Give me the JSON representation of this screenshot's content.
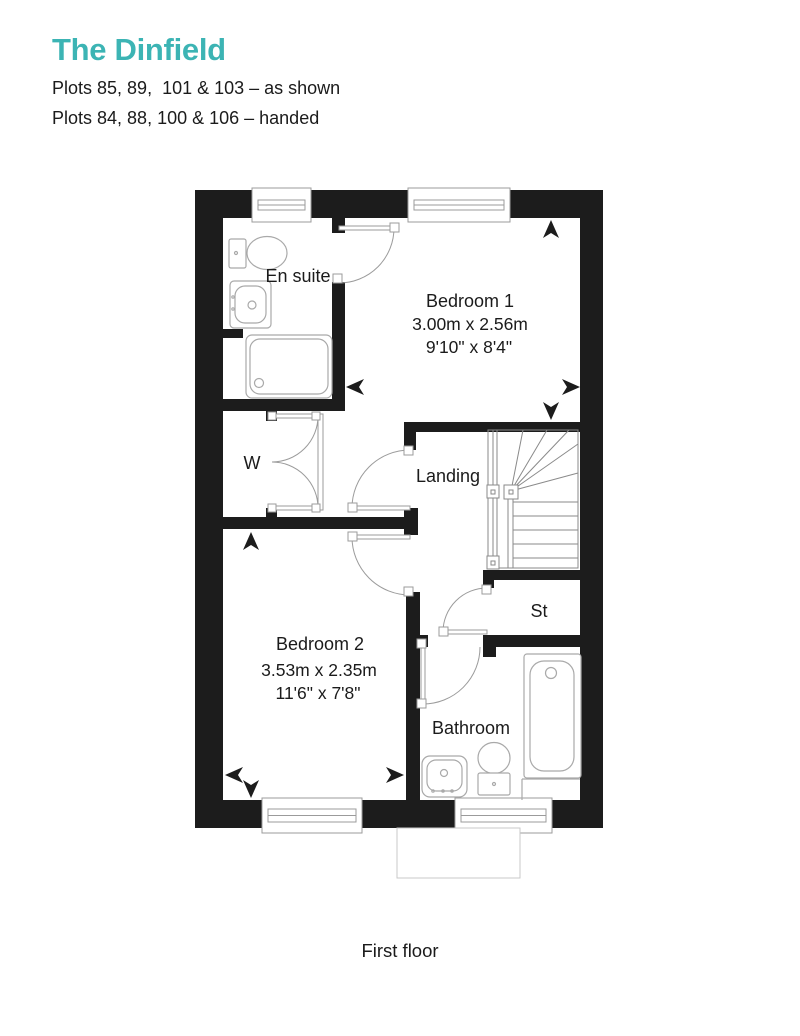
{
  "header": {
    "title": "The Dinfield",
    "plots_as_shown": "Plots 85, 89,  101 & 103 – as shown",
    "plots_handed": "Plots 84, 88, 100 & 106 – handed"
  },
  "floor_label": "First floor",
  "colors": {
    "accent_teal": "#3CB4B4",
    "wall_black": "#1C1C1C",
    "text_dark": "#1B1B1B",
    "plan_line_gray": "#9B9B9B"
  },
  "rooms": {
    "ensuite": {
      "label": "En suite"
    },
    "bedroom1": {
      "label": "Bedroom 1",
      "size_metric": "3.00m x 2.56m",
      "size_imperial": "9'10\" x 8'4\""
    },
    "wardrobe": {
      "label": "W"
    },
    "landing": {
      "label": "Landing"
    },
    "store": {
      "label": "St"
    },
    "bedroom2": {
      "label": "Bedroom 2",
      "size_metric": "3.53m x 2.35m",
      "size_imperial": "11'6\" x 7'8\""
    },
    "bathroom": {
      "label": "Bathroom"
    }
  }
}
